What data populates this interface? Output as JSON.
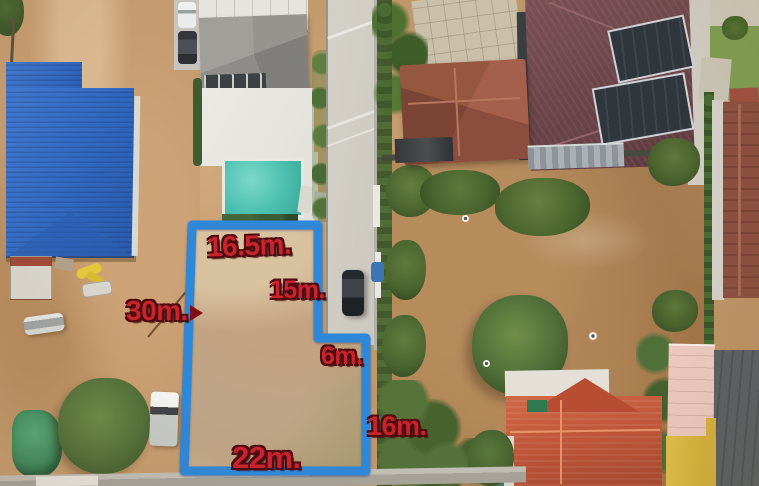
{
  "annotations": {
    "boundary_color": "#2f87d8",
    "label_color": "#c8242e",
    "labels": [
      {
        "id": "top-width",
        "text": "16.5m."
      },
      {
        "id": "upper-right-depth",
        "text": "15m."
      },
      {
        "id": "left-depth",
        "text": "30m."
      },
      {
        "id": "road-frontage",
        "text": "6m."
      },
      {
        "id": "bottom-width",
        "text": "22m."
      },
      {
        "id": "lower-right-depth",
        "text": "16m."
      }
    ]
  },
  "scene": {
    "key_colors": {
      "blue_metal_roof": "#336fc8",
      "pool_water": "#4cc0b0",
      "orange_tile_roof": "#c4573a",
      "maroon_solar_roof": "#6e464b",
      "road_concrete": "#d0cdc5",
      "bare_soil": "#c59c6f"
    }
  }
}
